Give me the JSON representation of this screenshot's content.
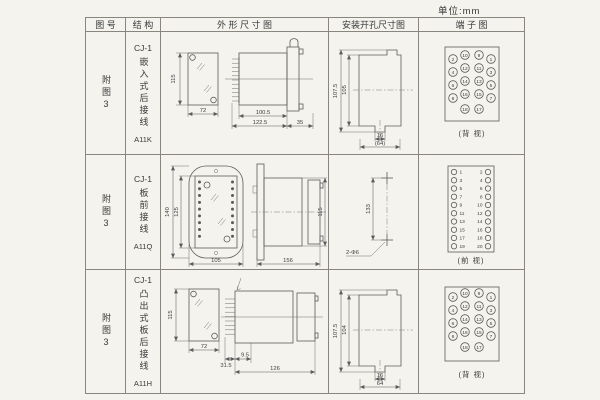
{
  "unit_label": "单位:mm",
  "colors": {
    "background": "#f5f3ee",
    "table_line": "#8a867f",
    "ink": "#3a3a3a"
  },
  "header": {
    "col_figure": "图 号",
    "col_structure": "结 构",
    "col_outline": "外 形 尺 寸 图",
    "col_install": "安装开孔尺寸图",
    "col_terminal": "端 子 图"
  },
  "rows": [
    {
      "figure_no": "附图3",
      "structure": {
        "model": "CJ-1",
        "desc": "嵌入式后接线",
        "code": "A11K"
      },
      "outline": {
        "front_h": "115",
        "front_w": "72",
        "body_len": "100.5",
        "total_len": "122.5",
        "flange_w": "35"
      },
      "install": {
        "outer_h": "107.5",
        "inner_h": "105",
        "slot_w": "16",
        "span_w": "(64)"
      },
      "terminal": {
        "type": "staggered",
        "rows": [
          [
            "2",
            "10",
            "9",
            "1"
          ],
          [
            "4",
            "12",
            "11",
            "3"
          ],
          [
            "6",
            "14",
            "13",
            "5"
          ],
          [
            "8",
            "16",
            "15",
            "7"
          ],
          [
            "18",
            "17"
          ]
        ],
        "view": "(背 视)"
      }
    },
    {
      "figure_no": "附图3",
      "structure": {
        "model": "CJ-1",
        "desc": "板前接线",
        "code": "A11Q"
      },
      "outline": {
        "front_h_outer": "140",
        "front_h_inner": "125",
        "front_w": "105",
        "side_len": "156",
        "side_h": "115"
      },
      "install": {
        "hole_dist": "133",
        "hole_note": "2-Φ6"
      },
      "terminal": {
        "type": "columns",
        "left": [
          "1",
          "3",
          "5",
          "7",
          "9",
          "11",
          "13",
          "15",
          "17",
          "19"
        ],
        "right": [
          "2",
          "4",
          "6",
          "8",
          "10",
          "12",
          "14",
          "16",
          "18",
          "20"
        ],
        "view": "(前 视)"
      }
    },
    {
      "figure_no": "附图3",
      "structure": {
        "model": "CJ-1",
        "desc": "凸出式板后接线",
        "code": "A11H"
      },
      "outline": {
        "front_h": "115",
        "front_w": "72",
        "pin_len": "31.5",
        "gap": "9.5",
        "body_len": "126"
      },
      "install": {
        "outer_h": "107.5",
        "inner_h": "104",
        "slot_w": "16",
        "span_w": "64"
      },
      "terminal": {
        "type": "staggered",
        "rows": [
          [
            "2",
            "10",
            "9",
            "1"
          ],
          [
            "4",
            "12",
            "11",
            "3"
          ],
          [
            "6",
            "14",
            "13",
            "5"
          ],
          [
            "8",
            "16",
            "15",
            "7"
          ],
          [
            "18",
            "17"
          ]
        ],
        "view": "(背 视)"
      }
    }
  ]
}
